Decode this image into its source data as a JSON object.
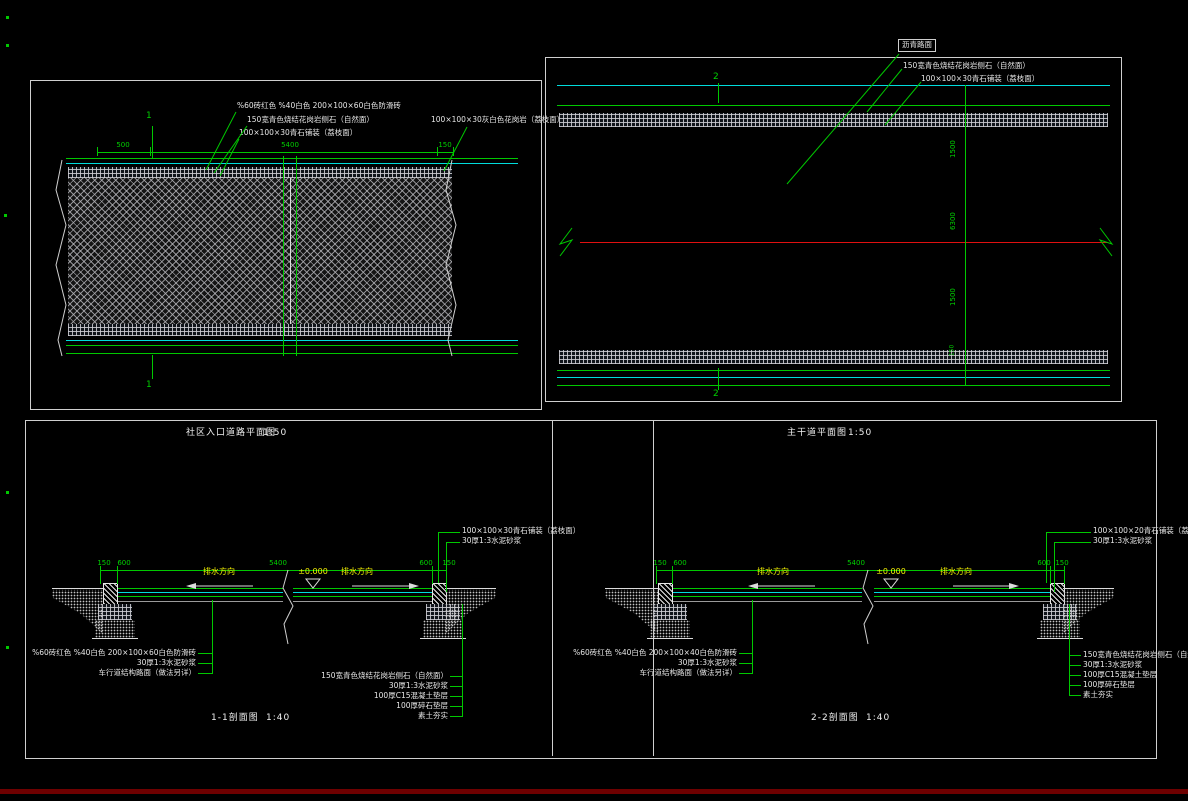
{
  "colors": {
    "background": "#000000",
    "line_green": "#00c800",
    "line_cyan": "#00dcdc",
    "line_white": "#dcdcdc",
    "centerline_red": "#e01010",
    "text_yellow": "#f2f200",
    "frame": "#cfcfcf",
    "bottom_bar": "#6e0000"
  },
  "entrance_plan": {
    "section_mark": "1",
    "labels": {
      "paver": "%60砖红色 %40白色 200×100×60白色防滑砖",
      "curb": "150宽青色烧结花岗岩侧石（自然面）",
      "edge_paving": "100×100×30青石铺装（荔枝面）",
      "right_paving": "100×100×30灰白色花岗岩（荔枝面）"
    },
    "dims": {
      "left": "500",
      "middle": "5400",
      "right": "150"
    }
  },
  "main_road_plan": {
    "section_mark": "2",
    "labels": {
      "asphalt": "沥青路面",
      "curb": "150宽青色烧结花岗岩侧石（自然面）",
      "edge_paving": "100×100×30青石铺装（荔枝面）"
    },
    "dims": {
      "top": "1500",
      "middle": "6300",
      "bottom": "1500",
      "edge": "150"
    }
  },
  "entrance_section": {
    "plan_title": "社区入口道路平面图",
    "plan_scale": "1:50",
    "title": "1-1剖面图",
    "scale": "1:40",
    "level": "±0.000",
    "flow_left": "排水方向",
    "flow_right": "排水方向",
    "dims": [
      "150",
      "600",
      "5400",
      "600",
      "150"
    ],
    "left_labels": [
      "%60砖红色 %40白色 200×100×60白色防滑砖",
      "30厚1:3水泥砂浆",
      "车行道结构路面（做法另详）"
    ],
    "right_labels": [
      "150宽青色烧结花岗岩侧石（自然面）",
      "30厚1:3水泥砂浆",
      "100厚C15混凝土垫层",
      "100厚碎石垫层",
      "素土夯实"
    ],
    "paving_labels": [
      "100×100×30青石铺装（荔枝面）",
      "30厚1:3水泥砂浆"
    ]
  },
  "main_road_section": {
    "plan_title": "主干道平面图",
    "plan_scale": "1:50",
    "title": "2-2剖面图",
    "scale": "1:40",
    "level": "±0.000",
    "flow_left": "排水方向",
    "flow_right": "排水方向",
    "dims": [
      "150",
      "600",
      "5400",
      "600",
      "150"
    ],
    "left_labels": [
      "%60砖红色 %40白色 200×100×40白色防滑砖",
      "30厚1:3水泥砂浆",
      "车行道结构路面（做法另详）"
    ],
    "right_labels": [
      "150宽青色烧结花岗岩侧石（自然面）",
      "30厚1:3水泥砂浆",
      "100厚C15混凝土垫层",
      "100厚碎石垫层",
      "素土夯实"
    ],
    "paving_labels": [
      "100×100×20青石铺装（荔枝面）",
      "30厚1:3水泥砂浆"
    ]
  }
}
